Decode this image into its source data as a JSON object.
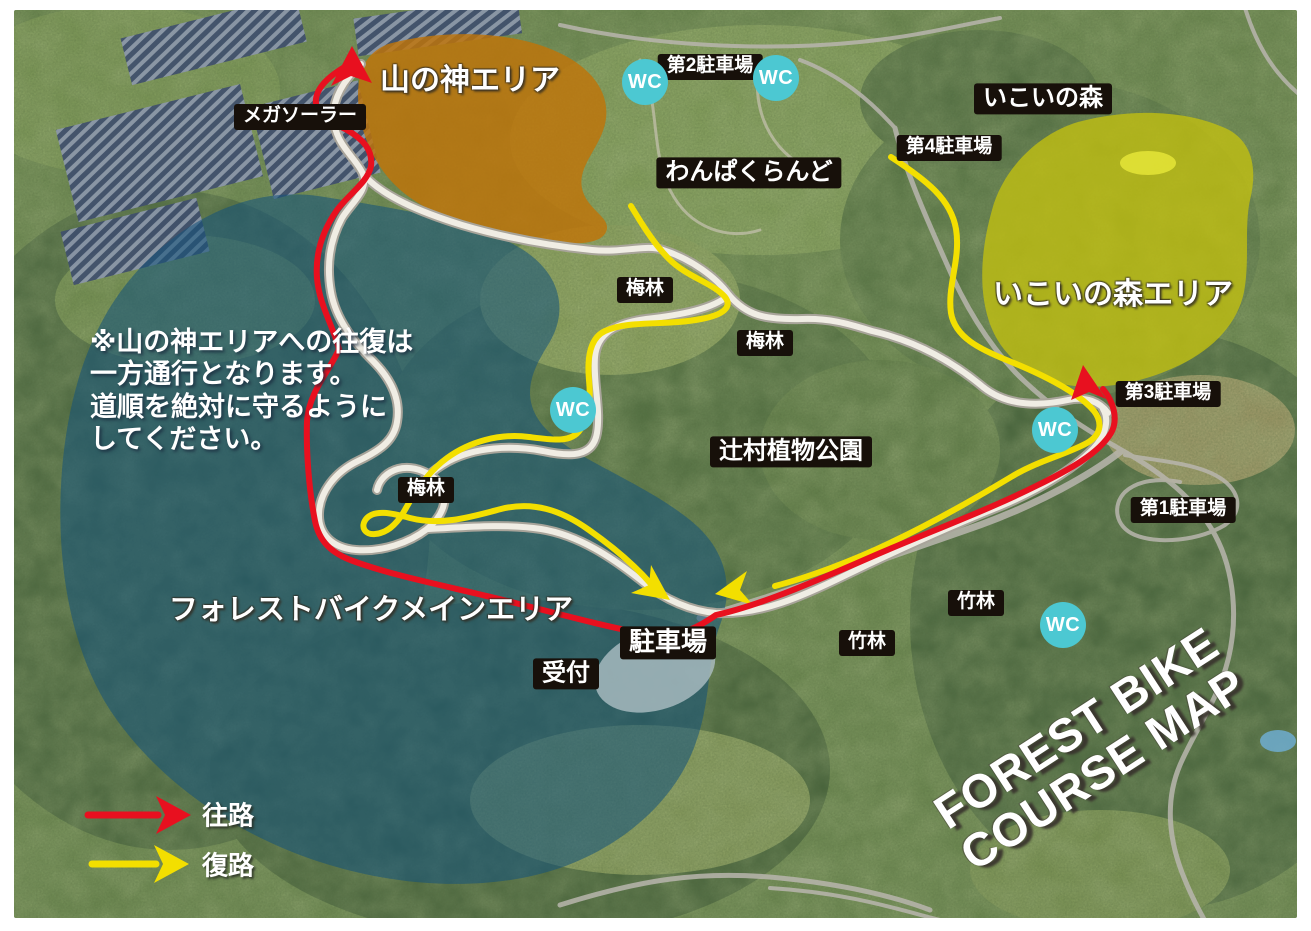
{
  "map": {
    "title_line1": "FOREST BIKE",
    "title_line2": "COURSE MAP"
  },
  "notice": {
    "line1": "※山の神エリアへの往復は",
    "line2": "一方通行となります。",
    "line3": "道順を絶対に守るように",
    "line4": "してください。"
  },
  "legend": {
    "outbound_label": "往路",
    "return_label": "復路",
    "outbound_color": "#e8101f",
    "return_color": "#f3df00"
  },
  "areas": {
    "yamanokami_label": "山の神エリア",
    "ikoinomori_area_label": "いこいの森エリア",
    "forest_bike_main_label": "フォレストバイクメインエリア"
  },
  "labels": {
    "mega_solar": "メガソーラー",
    "parking_no2": "第2駐車場",
    "wanpaku_land": "わんぱくらんど",
    "ikoi_no_mori": "いこいの森",
    "parking_no4": "第4駐車場",
    "plum_grove": "梅林",
    "parking_no3": "第3駐車場",
    "tsujimura_botanical_park": "辻村植物公園",
    "parking_no1": "第1駐車場",
    "parking_main": "駐車場",
    "reception": "受付",
    "bamboo_grove": "竹林",
    "wc": "WC"
  },
  "colors": {
    "route_outbound": "#e8101f",
    "route_return": "#f3df00",
    "course_path": "#f0ede4",
    "area_yamanokami": "#c07408",
    "area_ikoinomori": "#c3c010",
    "area_forest_bike_main": "#14527b",
    "wc_badge": "#4cc8d2"
  }
}
